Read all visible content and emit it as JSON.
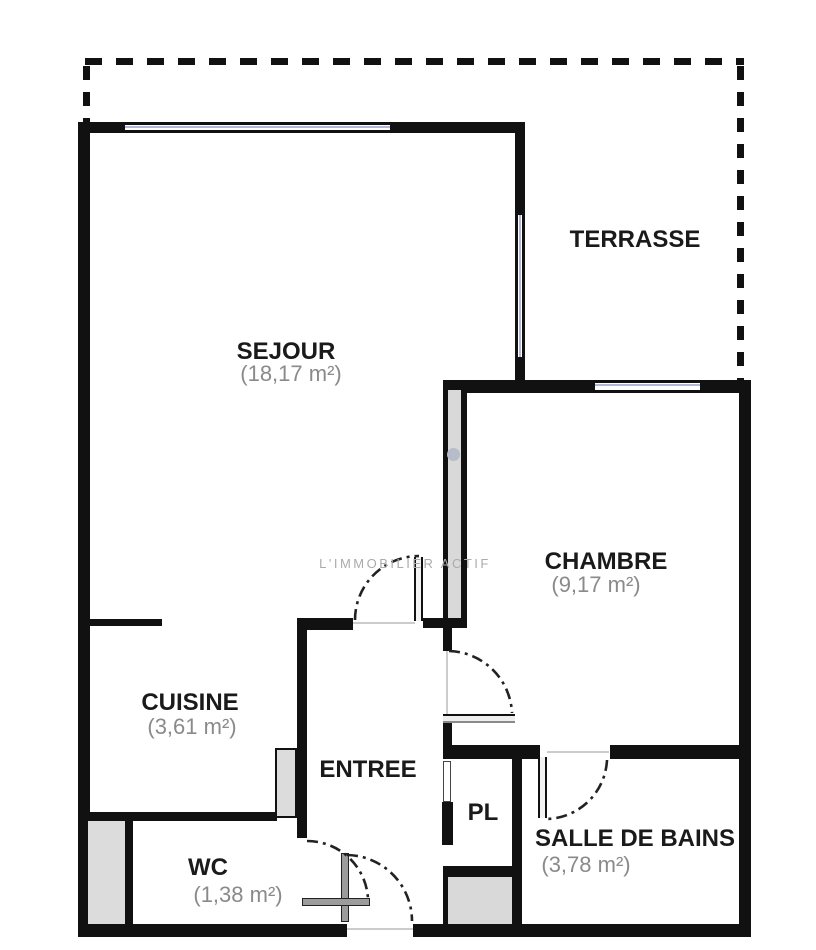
{
  "watermark": {
    "text": "L'IMMOBILIER ACTIF"
  },
  "rooms": {
    "terrasse": {
      "label": "TERRASSE"
    },
    "sejour": {
      "label": "SEJOUR",
      "area": "(18,17 m²)"
    },
    "chambre": {
      "label": "CHAMBRE",
      "area": "(9,17 m²)"
    },
    "cuisine": {
      "label": "CUISINE",
      "area": "(3,61 m²)"
    },
    "entree": {
      "label": "ENTREE"
    },
    "pl": {
      "label": "PL"
    },
    "salle_de_bains": {
      "label": "SALLE DE BAINS",
      "area": "(3,78 m²)"
    },
    "wc": {
      "label": "WC",
      "area": "(1,38 m²)"
    }
  },
  "colors": {
    "wall": "#111111",
    "wall_fill_gray": "#d9d9d9",
    "window_line": "#b4b8d8",
    "label_text": "#1a1a1a",
    "area_text": "#8a8a8a",
    "watermark": "#ababab"
  }
}
